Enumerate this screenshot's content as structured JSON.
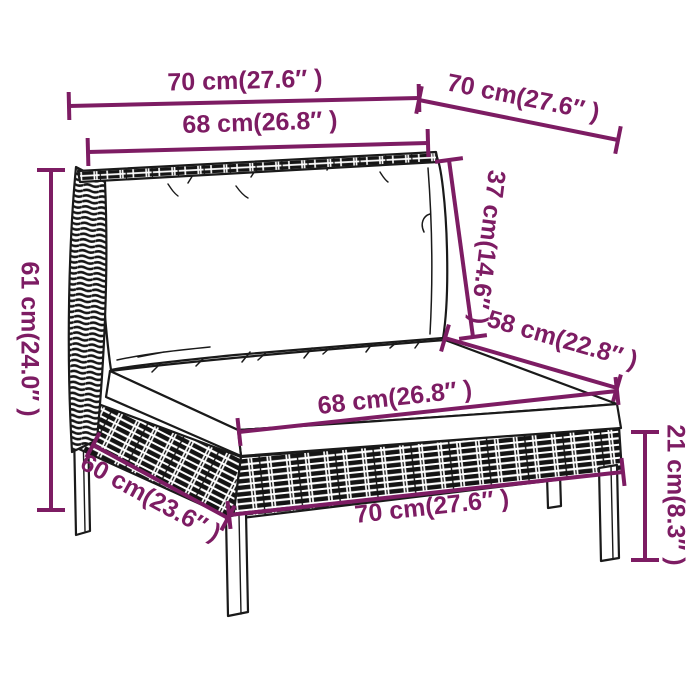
{
  "page": {
    "background": "#ffffff",
    "description": "Product dimension diagram of a poly rattan garden middle sofa with cushions"
  },
  "colors": {
    "dimension": "#7d1c63",
    "line_art": "#1a1a1a",
    "cushion_fill": "#ffffff",
    "weave_dark": "#151515"
  },
  "tick_half_length": 14,
  "line_width": 4,
  "dimensions": [
    {
      "id": "top-width",
      "label": "70 cm(27.6″ )",
      "line": [
        69,
        106,
        419,
        98
      ],
      "text": [
        245,
        82
      ],
      "rotate": -1.5
    },
    {
      "id": "top-depth",
      "label": "70 cm(27.6″ )",
      "line": [
        419,
        100,
        618,
        140
      ],
      "text": [
        523,
        99
      ],
      "rotate": 11.4
    },
    {
      "id": "back-cushion-width",
      "label": "68 cm(26.8″ )",
      "line": [
        88,
        152,
        428,
        143
      ],
      "text": [
        260,
        124
      ],
      "rotate": -1.8
    },
    {
      "id": "back-cushion-height",
      "label": "37 cm(14.6″ )",
      "line": [
        449,
        160,
        473,
        337
      ],
      "text": [
        486,
        247
      ],
      "rotate": 97
    },
    {
      "id": "overall-height",
      "label": "61 cm(24.0″ )",
      "line": [
        51,
        170,
        51,
        510
      ],
      "text": [
        28,
        339
      ],
      "rotate": 90
    },
    {
      "id": "seat-depth",
      "label": "58 cm(22.8″ )",
      "line": [
        445,
        338,
        617,
        388
      ],
      "text": [
        562,
        341
      ],
      "rotate": 16
    },
    {
      "id": "seat-cushion-width",
      "label": "68 cm(26.8″ )",
      "line": [
        239,
        432,
        617,
        391
      ],
      "text": [
        395,
        399
      ],
      "rotate": -6.3
    },
    {
      "id": "base-side-depth",
      "label": "60 cm(23.6″ )",
      "line": [
        93,
        445,
        228,
        518
      ],
      "text": [
        150,
        499
      ],
      "rotate": 28.5
    },
    {
      "id": "base-front-width",
      "label": "70 cm(27.6″ )",
      "line": [
        229,
        515,
        623,
        472
      ],
      "text": [
        432,
        508
      ],
      "rotate": -6.2
    },
    {
      "id": "seat-height",
      "label": "21 cm(8.3″ )",
      "line": [
        645,
        432,
        645,
        560
      ],
      "text": [
        674,
        495
      ],
      "rotate": 90
    }
  ]
}
